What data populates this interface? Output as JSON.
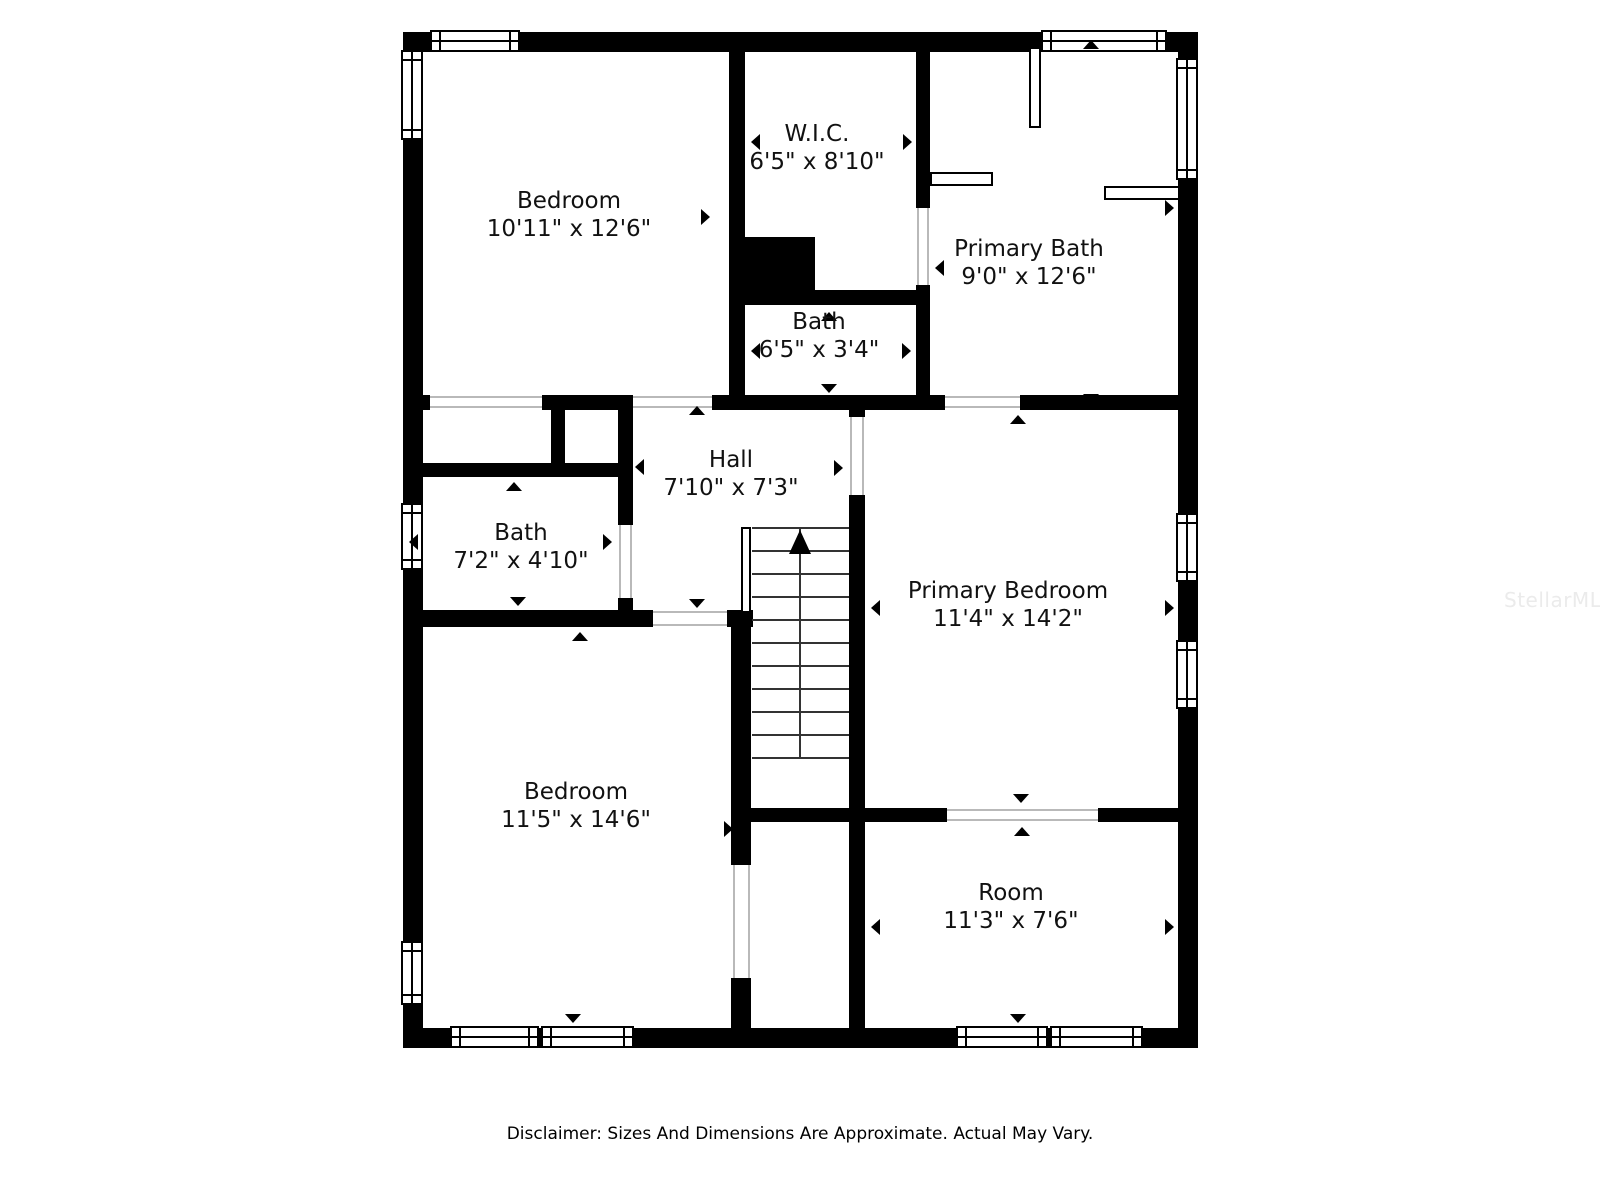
{
  "plan": {
    "watermark": "StellarMLS",
    "disclaimer": "Disclaimer: Sizes And Dimensions Are Approximate. Actual May Vary.",
    "colors": {
      "wall": "#000000",
      "background": "#ffffff",
      "label": "#111111",
      "watermark": "#ebebeb",
      "threshold": "#b9b9b9"
    },
    "watermark_pos": {
      "x": 1504,
      "y": 588
    },
    "rooms": [
      {
        "name": "Bedroom",
        "dims": "10'11\" x 12'6\"",
        "cx": 569,
        "cy": 215
      },
      {
        "name": "W.I.C.",
        "dims": "6'5\" x 8'10\"",
        "cx": 817,
        "cy": 148
      },
      {
        "name": "Primary Bath",
        "dims": "9'0\" x 12'6\"",
        "cx": 1029,
        "cy": 263
      },
      {
        "name": "Bath",
        "dims": "6'5\" x 3'4\"",
        "cx": 819,
        "cy": 336
      },
      {
        "name": "Hall",
        "dims": "7'10\" x 7'3\"",
        "cx": 731,
        "cy": 474
      },
      {
        "name": "Bath",
        "dims": "7'2\" x 4'10\"",
        "cx": 521,
        "cy": 547
      },
      {
        "name": "Primary Bedroom",
        "dims": "11'4\" x 14'2\"",
        "cx": 1008,
        "cy": 605
      },
      {
        "name": "Bedroom",
        "dims": "11'5\" x 14'6\"",
        "cx": 576,
        "cy": 806
      },
      {
        "name": "Room",
        "dims": "11'3\" x 7'6\"",
        "cx": 1011,
        "cy": 907
      }
    ],
    "walls": [
      {
        "x": 403,
        "y": 32,
        "w": 795,
        "h": 20
      },
      {
        "x": 403,
        "y": 1028,
        "w": 795,
        "h": 20
      },
      {
        "x": 403,
        "y": 32,
        "w": 20,
        "h": 1016
      },
      {
        "x": 1178,
        "y": 32,
        "w": 20,
        "h": 1016
      },
      {
        "x": 729,
        "y": 52,
        "w": 16,
        "h": 358
      },
      {
        "x": 729,
        "y": 237,
        "w": 86,
        "h": 68
      },
      {
        "x": 815,
        "y": 290,
        "w": 115,
        "h": 15
      },
      {
        "x": 916,
        "y": 52,
        "w": 14,
        "h": 156
      },
      {
        "x": 916,
        "y": 285,
        "w": 14,
        "h": 125
      },
      {
        "x": 403,
        "y": 395,
        "w": 27,
        "h": 15
      },
      {
        "x": 542,
        "y": 395,
        "w": 91,
        "h": 15
      },
      {
        "x": 712,
        "y": 395,
        "w": 233,
        "h": 15
      },
      {
        "x": 1020,
        "y": 395,
        "w": 178,
        "h": 15
      },
      {
        "x": 551,
        "y": 405,
        "w": 14,
        "h": 62
      },
      {
        "x": 403,
        "y": 463,
        "w": 230,
        "h": 14
      },
      {
        "x": 618,
        "y": 395,
        "w": 15,
        "h": 130
      },
      {
        "x": 618,
        "y": 598,
        "w": 15,
        "h": 29
      },
      {
        "x": 403,
        "y": 610,
        "w": 250,
        "h": 17
      },
      {
        "x": 727,
        "y": 610,
        "w": 26,
        "h": 17
      },
      {
        "x": 849,
        "y": 395,
        "w": 16,
        "h": 22
      },
      {
        "x": 849,
        "y": 495,
        "w": 16,
        "h": 327
      },
      {
        "x": 731,
        "y": 613,
        "w": 20,
        "h": 252
      },
      {
        "x": 731,
        "y": 978,
        "w": 20,
        "h": 50
      },
      {
        "x": 731,
        "y": 808,
        "w": 216,
        "h": 14
      },
      {
        "x": 1098,
        "y": 808,
        "w": 80,
        "h": 14
      },
      {
        "x": 849,
        "y": 822,
        "w": 16,
        "h": 206
      }
    ],
    "windows": [
      {
        "x": 430,
        "y": 30,
        "w": 90,
        "h": 22,
        "o": "h"
      },
      {
        "x": 1041,
        "y": 30,
        "w": 126,
        "h": 22,
        "o": "h"
      },
      {
        "x": 450,
        "y": 1026,
        "w": 89,
        "h": 22,
        "o": "h"
      },
      {
        "x": 541,
        "y": 1026,
        "w": 93,
        "h": 22,
        "o": "h"
      },
      {
        "x": 956,
        "y": 1026,
        "w": 92,
        "h": 22,
        "o": "h"
      },
      {
        "x": 1050,
        "y": 1026,
        "w": 93,
        "h": 22,
        "o": "h"
      },
      {
        "x": 401,
        "y": 50,
        "w": 22,
        "h": 90,
        "o": "v"
      },
      {
        "x": 401,
        "y": 503,
        "w": 22,
        "h": 67,
        "o": "v"
      },
      {
        "x": 401,
        "y": 941,
        "w": 22,
        "h": 64,
        "o": "v"
      },
      {
        "x": 1176,
        "y": 58,
        "w": 22,
        "h": 122,
        "o": "v"
      },
      {
        "x": 1176,
        "y": 513,
        "w": 22,
        "h": 69,
        "o": "v"
      },
      {
        "x": 1176,
        "y": 640,
        "w": 22,
        "h": 69,
        "o": "v"
      }
    ],
    "thresholds": [
      {
        "x": 430,
        "y": 396,
        "w": 112,
        "h": 2
      },
      {
        "x": 430,
        "y": 406,
        "w": 112,
        "h": 2
      },
      {
        "x": 633,
        "y": 396,
        "w": 79,
        "h": 2
      },
      {
        "x": 633,
        "y": 406,
        "w": 79,
        "h": 2
      },
      {
        "x": 945,
        "y": 396,
        "w": 75,
        "h": 2
      },
      {
        "x": 945,
        "y": 406,
        "w": 75,
        "h": 2
      },
      {
        "x": 917,
        "y": 208,
        "w": 2,
        "h": 77
      },
      {
        "x": 927,
        "y": 208,
        "w": 2,
        "h": 77
      },
      {
        "x": 619,
        "y": 525,
        "w": 2,
        "h": 73
      },
      {
        "x": 630,
        "y": 525,
        "w": 2,
        "h": 73
      },
      {
        "x": 653,
        "y": 611,
        "w": 74,
        "h": 2
      },
      {
        "x": 653,
        "y": 624,
        "w": 74,
        "h": 2
      },
      {
        "x": 850,
        "y": 417,
        "w": 2,
        "h": 78
      },
      {
        "x": 862,
        "y": 417,
        "w": 2,
        "h": 78
      },
      {
        "x": 733,
        "y": 865,
        "w": 2,
        "h": 113
      },
      {
        "x": 748,
        "y": 865,
        "w": 2,
        "h": 113
      },
      {
        "x": 947,
        "y": 809,
        "w": 151,
        "h": 2
      },
      {
        "x": 947,
        "y": 819,
        "w": 151,
        "h": 2
      }
    ],
    "fixtures": [
      {
        "x": 1029,
        "y": 47,
        "w": 12,
        "h": 81
      },
      {
        "x": 930,
        "y": 172,
        "w": 63,
        "h": 14
      },
      {
        "x": 1104,
        "y": 186,
        "w": 76,
        "h": 14
      },
      {
        "x": 741,
        "y": 527,
        "w": 10,
        "h": 86
      }
    ],
    "stairs": {
      "x": 752,
      "w": 97,
      "top": 527,
      "gap": 23,
      "count": 11,
      "divider_x": 799,
      "bottom": 757,
      "arrow": {
        "x": 789,
        "y": 530
      }
    },
    "arrows": [
      {
        "x": 565,
        "y": 40,
        "d": "up"
      },
      {
        "x": 409,
        "y": 217,
        "d": "left"
      },
      {
        "x": 710,
        "y": 217,
        "d": "right"
      },
      {
        "x": 568,
        "y": 404,
        "d": "down"
      },
      {
        "x": 865,
        "y": 40,
        "d": "up"
      },
      {
        "x": 751,
        "y": 142,
        "d": "left"
      },
      {
        "x": 912,
        "y": 142,
        "d": "right"
      },
      {
        "x": 864,
        "y": 301,
        "d": "down"
      },
      {
        "x": 1091,
        "y": 40,
        "d": "up"
      },
      {
        "x": 935,
        "y": 268,
        "d": "left"
      },
      {
        "x": 1174,
        "y": 208,
        "d": "right"
      },
      {
        "x": 1091,
        "y": 403,
        "d": "down"
      },
      {
        "x": 829,
        "y": 312,
        "d": "up"
      },
      {
        "x": 751,
        "y": 351,
        "d": "left"
      },
      {
        "x": 911,
        "y": 351,
        "d": "right"
      },
      {
        "x": 829,
        "y": 393,
        "d": "down"
      },
      {
        "x": 697,
        "y": 406,
        "d": "up"
      },
      {
        "x": 635,
        "y": 467,
        "d": "left"
      },
      {
        "x": 843,
        "y": 468,
        "d": "right"
      },
      {
        "x": 697,
        "y": 608,
        "d": "down"
      },
      {
        "x": 514,
        "y": 482,
        "d": "up"
      },
      {
        "x": 409,
        "y": 542,
        "d": "left"
      },
      {
        "x": 612,
        "y": 542,
        "d": "right"
      },
      {
        "x": 518,
        "y": 606,
        "d": "down"
      },
      {
        "x": 1018,
        "y": 415,
        "d": "up"
      },
      {
        "x": 871,
        "y": 608,
        "d": "left"
      },
      {
        "x": 1174,
        "y": 608,
        "d": "right"
      },
      {
        "x": 1021,
        "y": 803,
        "d": "down"
      },
      {
        "x": 580,
        "y": 632,
        "d": "up"
      },
      {
        "x": 409,
        "y": 827,
        "d": "left"
      },
      {
        "x": 733,
        "y": 829,
        "d": "right"
      },
      {
        "x": 573,
        "y": 1023,
        "d": "down"
      },
      {
        "x": 1022,
        "y": 827,
        "d": "up"
      },
      {
        "x": 871,
        "y": 927,
        "d": "left"
      },
      {
        "x": 1174,
        "y": 927,
        "d": "right"
      },
      {
        "x": 1018,
        "y": 1023,
        "d": "down"
      }
    ]
  }
}
